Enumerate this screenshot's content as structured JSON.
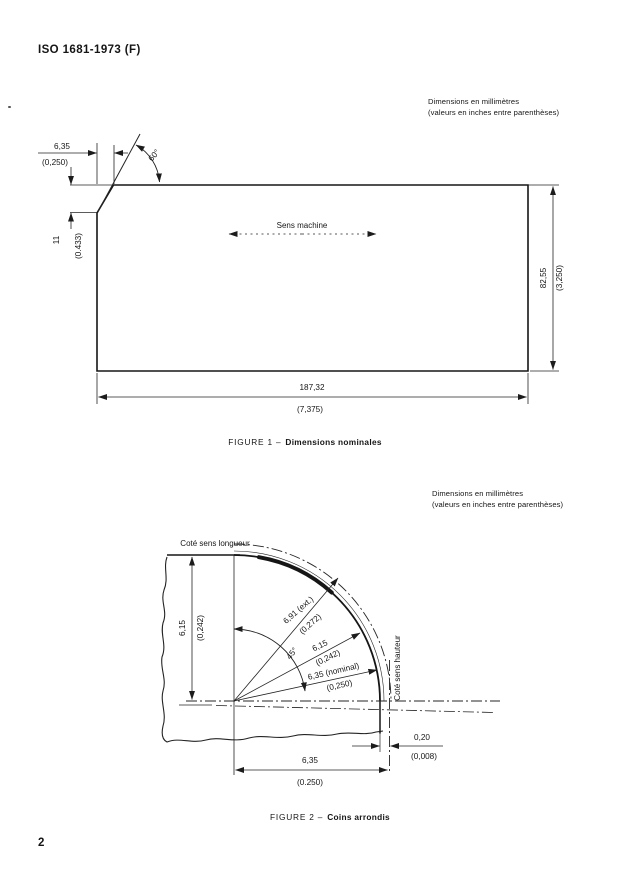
{
  "page": {
    "header_title": "ISO 1681-1973 (F)",
    "page_number": "2"
  },
  "notes": {
    "line1": "Dimensions en millimètres",
    "line2": "(valeurs en inches entre parenthèses)"
  },
  "figure1": {
    "caption_label": "FIGURE 1 –",
    "caption_title": "Dimensions nominales",
    "dim_width_mm": "187,32",
    "dim_width_in": "(7,375)",
    "dim_height_mm": "82,55",
    "dim_height_in": "(3,250)",
    "dim_bevel_h_mm": "6,35",
    "dim_bevel_h_in": "(0,250)",
    "dim_bevel_v_mm": "11",
    "dim_bevel_v_in": "(0.433)",
    "angle_label": "60°",
    "machine_direction_label": "Sens machine"
  },
  "figure2": {
    "caption_label": "FIGURE 2 –",
    "caption_title": "Coins arrondis",
    "edge_top_label": "Coté sens longueur",
    "edge_right_label": "Coté sens hauteur",
    "angle_label": "45°",
    "radius_ext_mm": "6,91 (ext.)",
    "radius_ext_in": "(0,272)",
    "radius_mid_mm": "6,15",
    "radius_mid_in": "(0,242)",
    "radius_nom_mm": "6,35 (nominal)",
    "radius_nom_in": "(0,250)",
    "offset_left_mm": "6,15",
    "offset_left_in": "(0,242)",
    "gap_mm": "0,20",
    "gap_in": "(0,008)",
    "base_mm": "6,35",
    "base_in": "(0.250)"
  }
}
